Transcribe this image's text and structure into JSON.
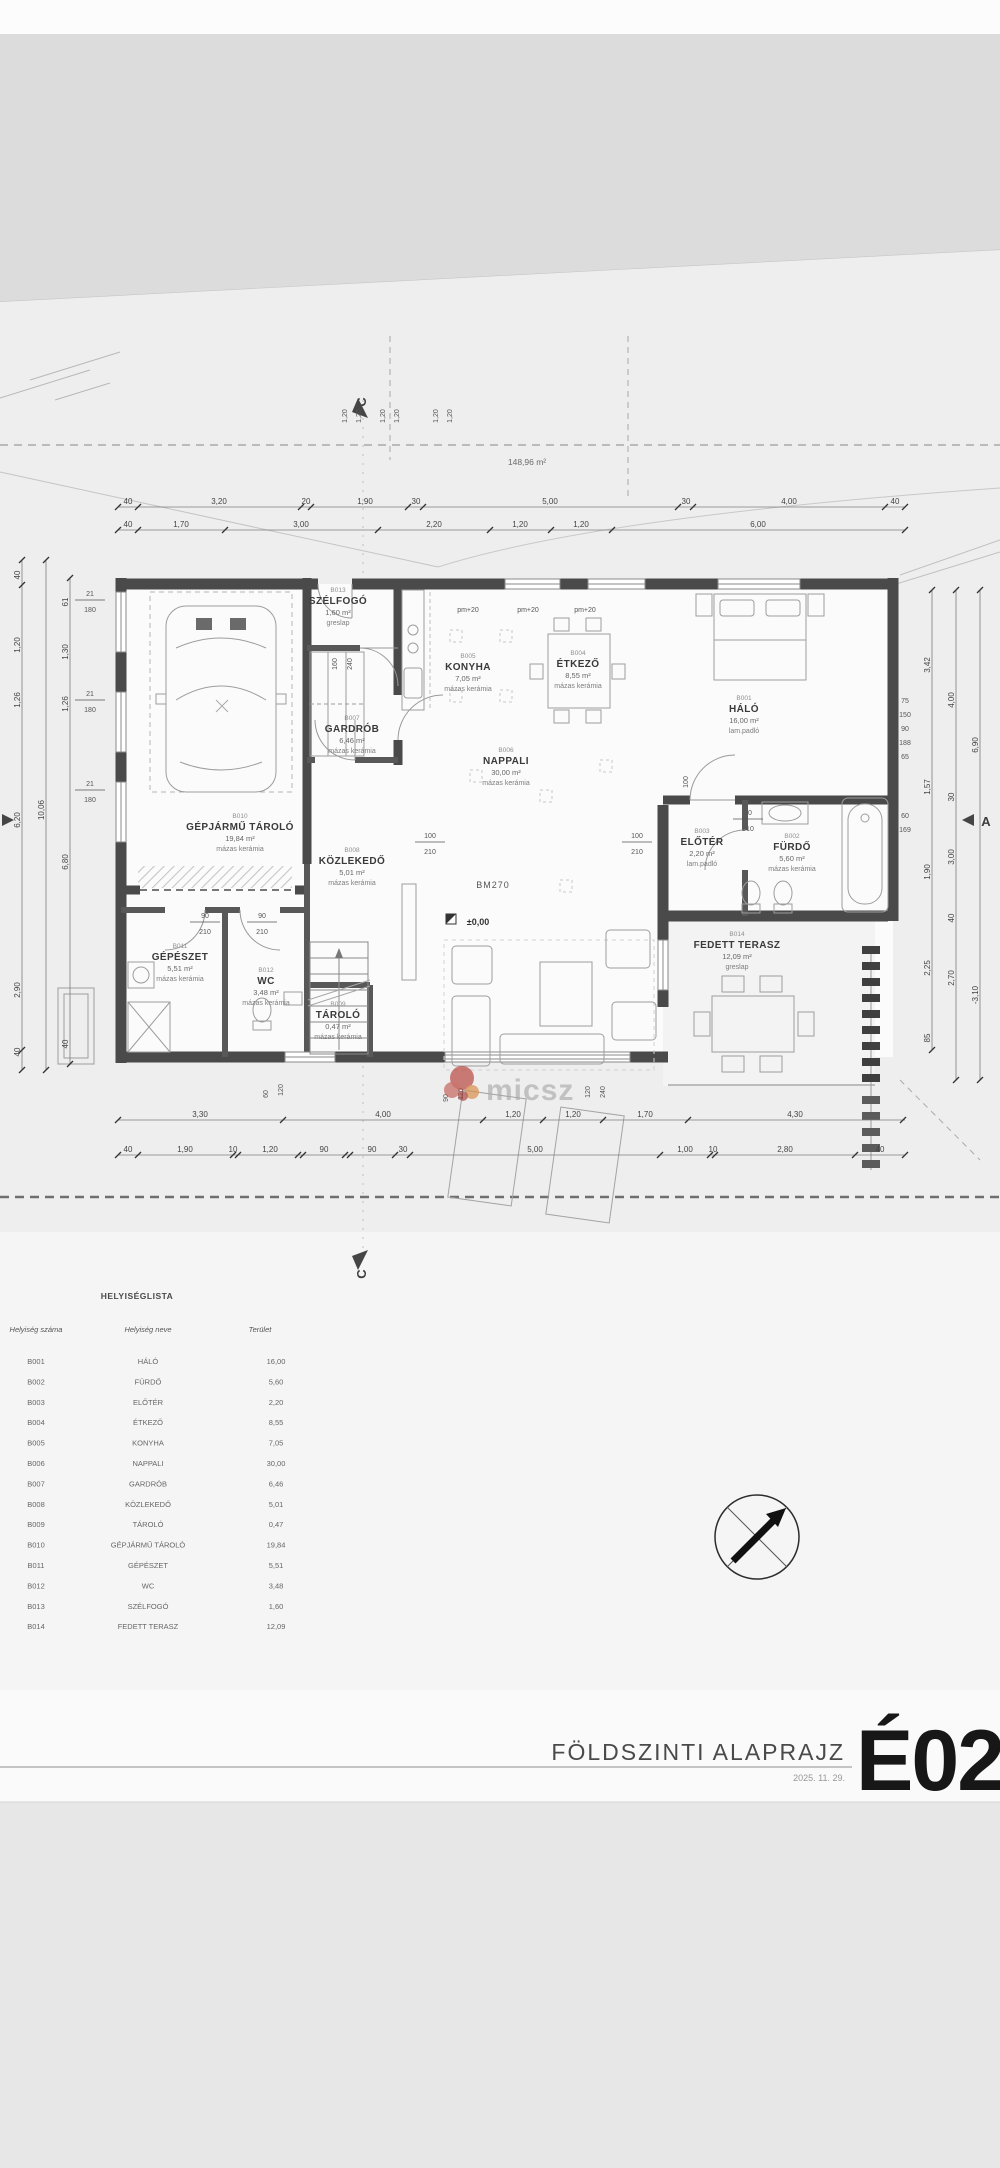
{
  "meta": {
    "sheet_title": "FÖLDSZINTI ALAPRAJZ",
    "sheet_date": "2025. 11. 29.",
    "sheet_code": "É02",
    "area_note": "148,96 m²",
    "level_mark": "±0,00",
    "beam_mark": "BM270",
    "watermark_text": "micsz"
  },
  "markers": {
    "section_c": "C",
    "section_a": "A"
  },
  "rooms": [
    {
      "code": "B013",
      "name": "SZÉLFOGÓ",
      "area": "1,60 m²",
      "floor": "greslap",
      "x": 338,
      "y": 592
    },
    {
      "code": "B005",
      "name": "KONYHA",
      "area": "7,05 m²",
      "floor": "mázas kerámia",
      "x": 468,
      "y": 658
    },
    {
      "code": "B004",
      "name": "ÉTKEZŐ",
      "area": "8,55 m²",
      "floor": "mázas kerámia",
      "x": 578,
      "y": 655
    },
    {
      "code": "B001",
      "name": "HÁLÓ",
      "area": "16,00 m²",
      "floor": "lam.padló",
      "x": 744,
      "y": 700
    },
    {
      "code": "B007",
      "name": "GARDRÓB",
      "area": "6,46 m²",
      "floor": "mázas kerámia",
      "x": 352,
      "y": 720
    },
    {
      "code": "B006",
      "name": "NAPPALI",
      "area": "30,00 m²",
      "floor": "mázas kerámia",
      "x": 506,
      "y": 752
    },
    {
      "code": "B010",
      "name": "GÉPJÁRMŰ TÁROLÓ",
      "area": "19,84 m²",
      "floor": "mázas kerámia",
      "x": 240,
      "y": 818
    },
    {
      "code": "B008",
      "name": "KÖZLEKEDŐ",
      "area": "5,01 m²",
      "floor": "mázas kerámia",
      "x": 352,
      "y": 852
    },
    {
      "code": "B003",
      "name": "ELŐTÉR",
      "area": "2,20 m²",
      "floor": "lam.padló",
      "x": 702,
      "y": 833
    },
    {
      "code": "B002",
      "name": "FÜRDŐ",
      "area": "5,60 m²",
      "floor": "mázas kerámia",
      "x": 792,
      "y": 838
    },
    {
      "code": "B014",
      "name": "FEDETT TERASZ",
      "area": "12,09 m²",
      "floor": "greslap",
      "x": 737,
      "y": 936
    },
    {
      "code": "B011",
      "name": "GÉPÉSZET",
      "area": "5,51 m²",
      "floor": "mázas kerámia",
      "x": 180,
      "y": 948
    },
    {
      "code": "B012",
      "name": "WC",
      "area": "3,48 m²",
      "floor": "mázas kerámia",
      "x": 266,
      "y": 972
    },
    {
      "code": "B009",
      "name": "TÁROLÓ",
      "area": "0,47 m²",
      "floor": "mázas kerámia",
      "x": 338,
      "y": 1006
    }
  ],
  "dim_chains": [
    {
      "o": "h",
      "pos": 507,
      "a": 118,
      "b": 905,
      "ticks": [
        118,
        138,
        301,
        311,
        408,
        423,
        678,
        693,
        885,
        905
      ],
      "labels": [
        {
          "t": "40",
          "at": 128
        },
        {
          "t": "3,20",
          "at": 219
        },
        {
          "t": "20",
          "at": 306
        },
        {
          "t": "1,90",
          "at": 365
        },
        {
          "t": "30",
          "at": 416
        },
        {
          "t": "5,00",
          "at": 550
        },
        {
          "t": "30",
          "at": 686
        },
        {
          "t": "4,00",
          "at": 789
        },
        {
          "t": "40",
          "at": 895
        }
      ]
    },
    {
      "o": "h",
      "pos": 530,
      "a": 118,
      "b": 905,
      "ticks": [
        118,
        138,
        225,
        378,
        490,
        551,
        612,
        905
      ],
      "labels": [
        {
          "t": "40",
          "at": 128
        },
        {
          "t": "1,70",
          "at": 181
        },
        {
          "t": "3,00",
          "at": 301
        },
        {
          "t": "2,20",
          "at": 434
        },
        {
          "t": "1,20",
          "at": 520
        },
        {
          "t": "1,20",
          "at": 581
        },
        {
          "t": "6,00",
          "at": 758
        }
      ]
    },
    {
      "o": "h",
      "pos": 1120,
      "a": 118,
      "b": 905,
      "ticks": [
        118,
        283,
        483,
        543,
        603,
        688,
        903
      ],
      "labels": [
        {
          "t": "3,30",
          "at": 200
        },
        {
          "t": "4,00",
          "at": 383
        },
        {
          "t": "1,20",
          "at": 513
        },
        {
          "t": "1,20",
          "at": 573
        },
        {
          "t": "1,70",
          "at": 645
        },
        {
          "t": "4,30",
          "at": 795
        }
      ]
    },
    {
      "o": "h",
      "pos": 1155,
      "a": 118,
      "b": 905,
      "ticks": [
        118,
        138,
        233,
        238,
        298,
        303,
        345,
        350,
        395,
        410,
        660,
        710,
        715,
        855,
        905
      ],
      "labels": [
        {
          "t": "40",
          "at": 128
        },
        {
          "t": "1,90",
          "at": 185
        },
        {
          "t": "10",
          "at": 233
        },
        {
          "t": "1,20",
          "at": 270
        },
        {
          "t": "90",
          "at": 324
        },
        {
          "t": "90",
          "at": 372
        },
        {
          "t": "30",
          "at": 403
        },
        {
          "t": "5,00",
          "at": 535
        },
        {
          "t": "1,00",
          "at": 685
        },
        {
          "t": "10",
          "at": 713
        },
        {
          "t": "2,80",
          "at": 785
        },
        {
          "t": "40",
          "at": 880
        }
      ]
    },
    {
      "o": "v",
      "pos": 22,
      "a": 560,
      "b": 1070,
      "ticks": [
        560,
        585,
        1050,
        1070
      ],
      "labels": [
        {
          "t": "40",
          "at": 575
        },
        {
          "t": "1,20",
          "at": 645
        },
        {
          "t": "1,26",
          "at": 700
        },
        {
          "t": "6,20",
          "at": 820
        },
        {
          "t": "2,90",
          "at": 990
        },
        {
          "t": "40",
          "at": 1052
        }
      ]
    },
    {
      "o": "v",
      "pos": 46,
      "a": 560,
      "b": 1070,
      "ticks": [
        560,
        1070
      ],
      "labels": [
        {
          "t": "10,06",
          "at": 810
        }
      ]
    },
    {
      "o": "v",
      "pos": 70,
      "a": 578,
      "b": 1064,
      "ticks": [
        578,
        1064
      ],
      "labels": [
        {
          "t": "61",
          "at": 602
        },
        {
          "t": "1,30",
          "at": 652
        },
        {
          "t": "1,26",
          "at": 704
        },
        {
          "t": "6,80",
          "at": 862
        },
        {
          "t": "40",
          "at": 1044
        }
      ]
    },
    {
      "o": "v",
      "pos": 932,
      "a": 590,
      "b": 1050,
      "ticks": [
        590,
        1050
      ],
      "labels": [
        {
          "t": "3,42",
          "at": 665
        },
        {
          "t": "1,57",
          "at": 787
        },
        {
          "t": "1,90",
          "at": 872
        },
        {
          "t": "2,25",
          "at": 968
        },
        {
          "t": "85",
          "at": 1038
        }
      ]
    },
    {
      "o": "v",
      "pos": 956,
      "a": 590,
      "b": 1080,
      "ticks": [
        590,
        1080
      ],
      "labels": [
        {
          "t": "4,00",
          "at": 700
        },
        {
          "t": "30",
          "at": 797
        },
        {
          "t": "3,00",
          "at": 857
        },
        {
          "t": "40",
          "at": 918
        },
        {
          "t": "2,70",
          "at": 978
        }
      ]
    },
    {
      "o": "v",
      "pos": 980,
      "a": 590,
      "b": 1080,
      "ticks": [
        590,
        1080
      ],
      "labels": [
        {
          "t": "6,90",
          "at": 745
        },
        {
          "t": "-3,10",
          "at": 995
        }
      ]
    }
  ],
  "dim_floaters": [
    {
      "t": "1,20",
      "x": 347,
      "y": 416,
      "r": 1
    },
    {
      "t": "1,20",
      "x": 361,
      "y": 416,
      "r": 1
    },
    {
      "t": "1,20",
      "x": 385,
      "y": 416,
      "r": 1
    },
    {
      "t": "1,20",
      "x": 399,
      "y": 416,
      "r": 1
    },
    {
      "t": "1,20",
      "x": 438,
      "y": 416,
      "r": 1
    },
    {
      "t": "1,20",
      "x": 452,
      "y": 416,
      "r": 1
    },
    {
      "t": "pm+20",
      "x": 468,
      "y": 612
    },
    {
      "t": "pm+20",
      "x": 528,
      "y": 612
    },
    {
      "t": "pm+20",
      "x": 585,
      "y": 612
    },
    {
      "t": "160",
      "x": 337,
      "y": 664,
      "r": 1
    },
    {
      "t": "240",
      "x": 352,
      "y": 664,
      "r": 1
    },
    {
      "t": "100",
      "x": 688,
      "y": 782,
      "r": 1
    },
    {
      "t": "60",
      "x": 268,
      "y": 1094,
      "r": 1
    },
    {
      "t": "120",
      "x": 283,
      "y": 1090,
      "r": 1
    },
    {
      "t": "90",
      "x": 448,
      "y": 1098,
      "r": 1
    },
    {
      "t": "120",
      "x": 463,
      "y": 1094,
      "r": 1
    },
    {
      "t": "120",
      "x": 590,
      "y": 1092,
      "r": 1
    },
    {
      "t": "240",
      "x": 605,
      "y": 1092,
      "r": 1
    },
    {
      "t": "75",
      "x": 905,
      "y": 703
    },
    {
      "t": "150",
      "x": 905,
      "y": 717
    },
    {
      "t": "90",
      "x": 905,
      "y": 731
    },
    {
      "t": "188",
      "x": 905,
      "y": 745
    },
    {
      "t": "65",
      "x": 905,
      "y": 759
    },
    {
      "t": "60",
      "x": 905,
      "y": 818
    },
    {
      "t": "169",
      "x": 905,
      "y": 832
    }
  ],
  "dim_stacks": [
    {
      "a": "21",
      "b": "180",
      "x": 90,
      "y": 596
    },
    {
      "a": "21",
      "b": "180",
      "x": 90,
      "y": 696
    },
    {
      "a": "21",
      "b": "180",
      "x": 90,
      "y": 786
    },
    {
      "a": "100",
      "b": "210",
      "x": 430,
      "y": 838
    },
    {
      "a": "100",
      "b": "210",
      "x": 637,
      "y": 838
    },
    {
      "a": "90",
      "b": "210",
      "x": 748,
      "y": 815
    },
    {
      "a": "90",
      "b": "210",
      "x": 205,
      "y": 918
    },
    {
      "a": "90",
      "b": "210",
      "x": 262,
      "y": 918
    }
  ],
  "room_list": {
    "title": "HELYISÉGLISTA",
    "columns": [
      "Helyiség száma",
      "Helyiség neve",
      "Terület"
    ],
    "rows": [
      [
        "B001",
        "HÁLÓ",
        "16,00"
      ],
      [
        "B002",
        "FÜRDŐ",
        "5,60"
      ],
      [
        "B003",
        "ELŐTÉR",
        "2,20"
      ],
      [
        "B004",
        "ÉTKEZŐ",
        "8,55"
      ],
      [
        "B005",
        "KONYHA",
        "7,05"
      ],
      [
        "B006",
        "NAPPALI",
        "30,00"
      ],
      [
        "B007",
        "GARDRÓB",
        "6,46"
      ],
      [
        "B008",
        "KÖZLEKEDŐ",
        "5,01"
      ],
      [
        "B009",
        "TÁROLÓ",
        "0,47"
      ],
      [
        "B010",
        "GÉPJÁRMŰ TÁROLÓ",
        "19,84"
      ],
      [
        "B011",
        "GÉPÉSZET",
        "5,51"
      ],
      [
        "B012",
        "WC",
        "3,48"
      ],
      [
        "B013",
        "SZÉLFOGÓ",
        "1,60"
      ],
      [
        "B014",
        "FEDETT TERASZ",
        "12,09"
      ]
    ]
  },
  "colors": {
    "wall": "#4a4a4a",
    "accent_red": "#b8423a",
    "paper": "#f2f2f2"
  }
}
